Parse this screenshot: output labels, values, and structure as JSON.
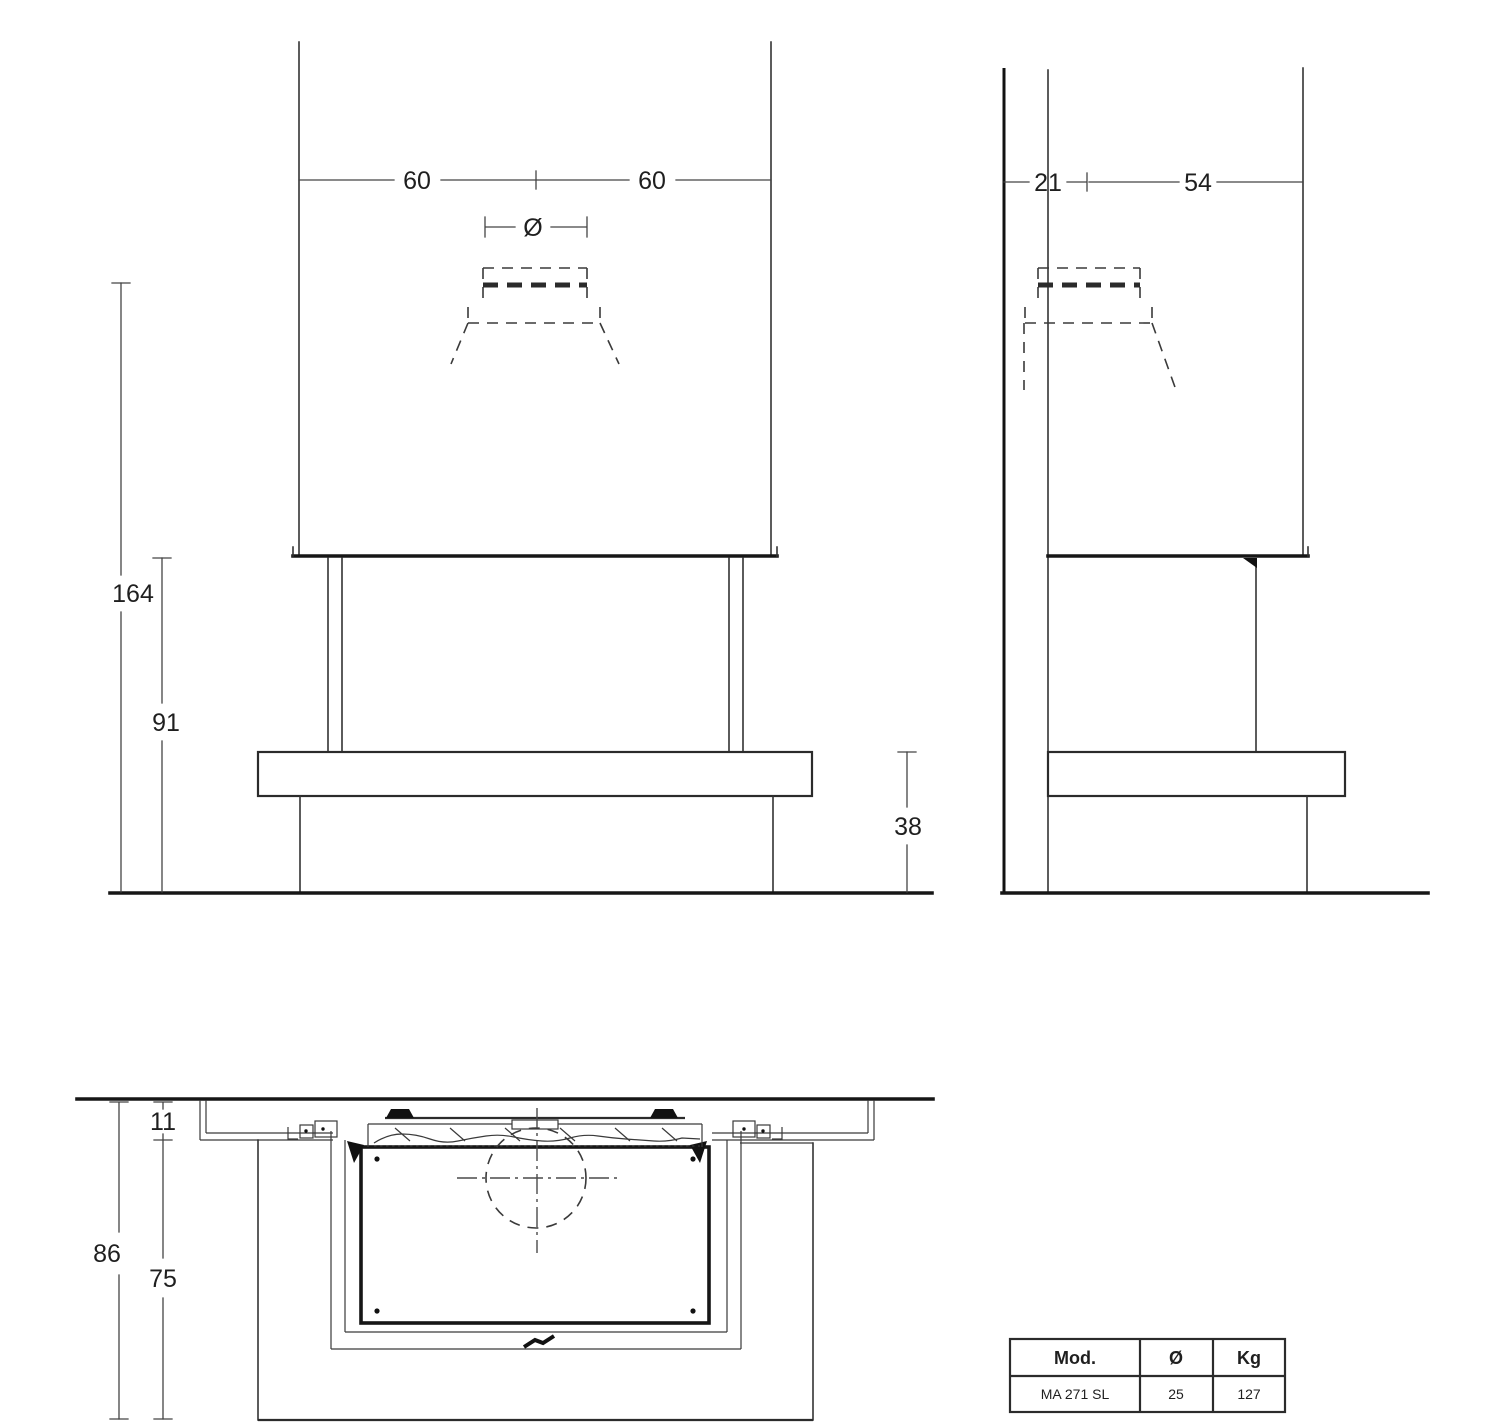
{
  "views": {
    "front": {
      "dim_width_left": "60",
      "dim_width_right": "60",
      "diameter_symbol": "Ø",
      "dim_height_total": "164",
      "dim_height_opening": "91",
      "dim_height_bench": "38"
    },
    "side": {
      "dim_wall_to_flue": "21",
      "dim_flue_to_front": "54"
    },
    "plan": {
      "dim_recess": "11",
      "dim_depth_total": "86",
      "dim_depth_bench": "75"
    }
  },
  "spec_table": {
    "headers": [
      "Mod.",
      "Ø",
      "Kg"
    ],
    "rows": [
      [
        "MA 271 SL",
        "25",
        "127"
      ]
    ]
  },
  "colors": {
    "line": "#333333",
    "line_dark": "#111111",
    "text": "#1f1f1f",
    "background": "#ffffff"
  }
}
